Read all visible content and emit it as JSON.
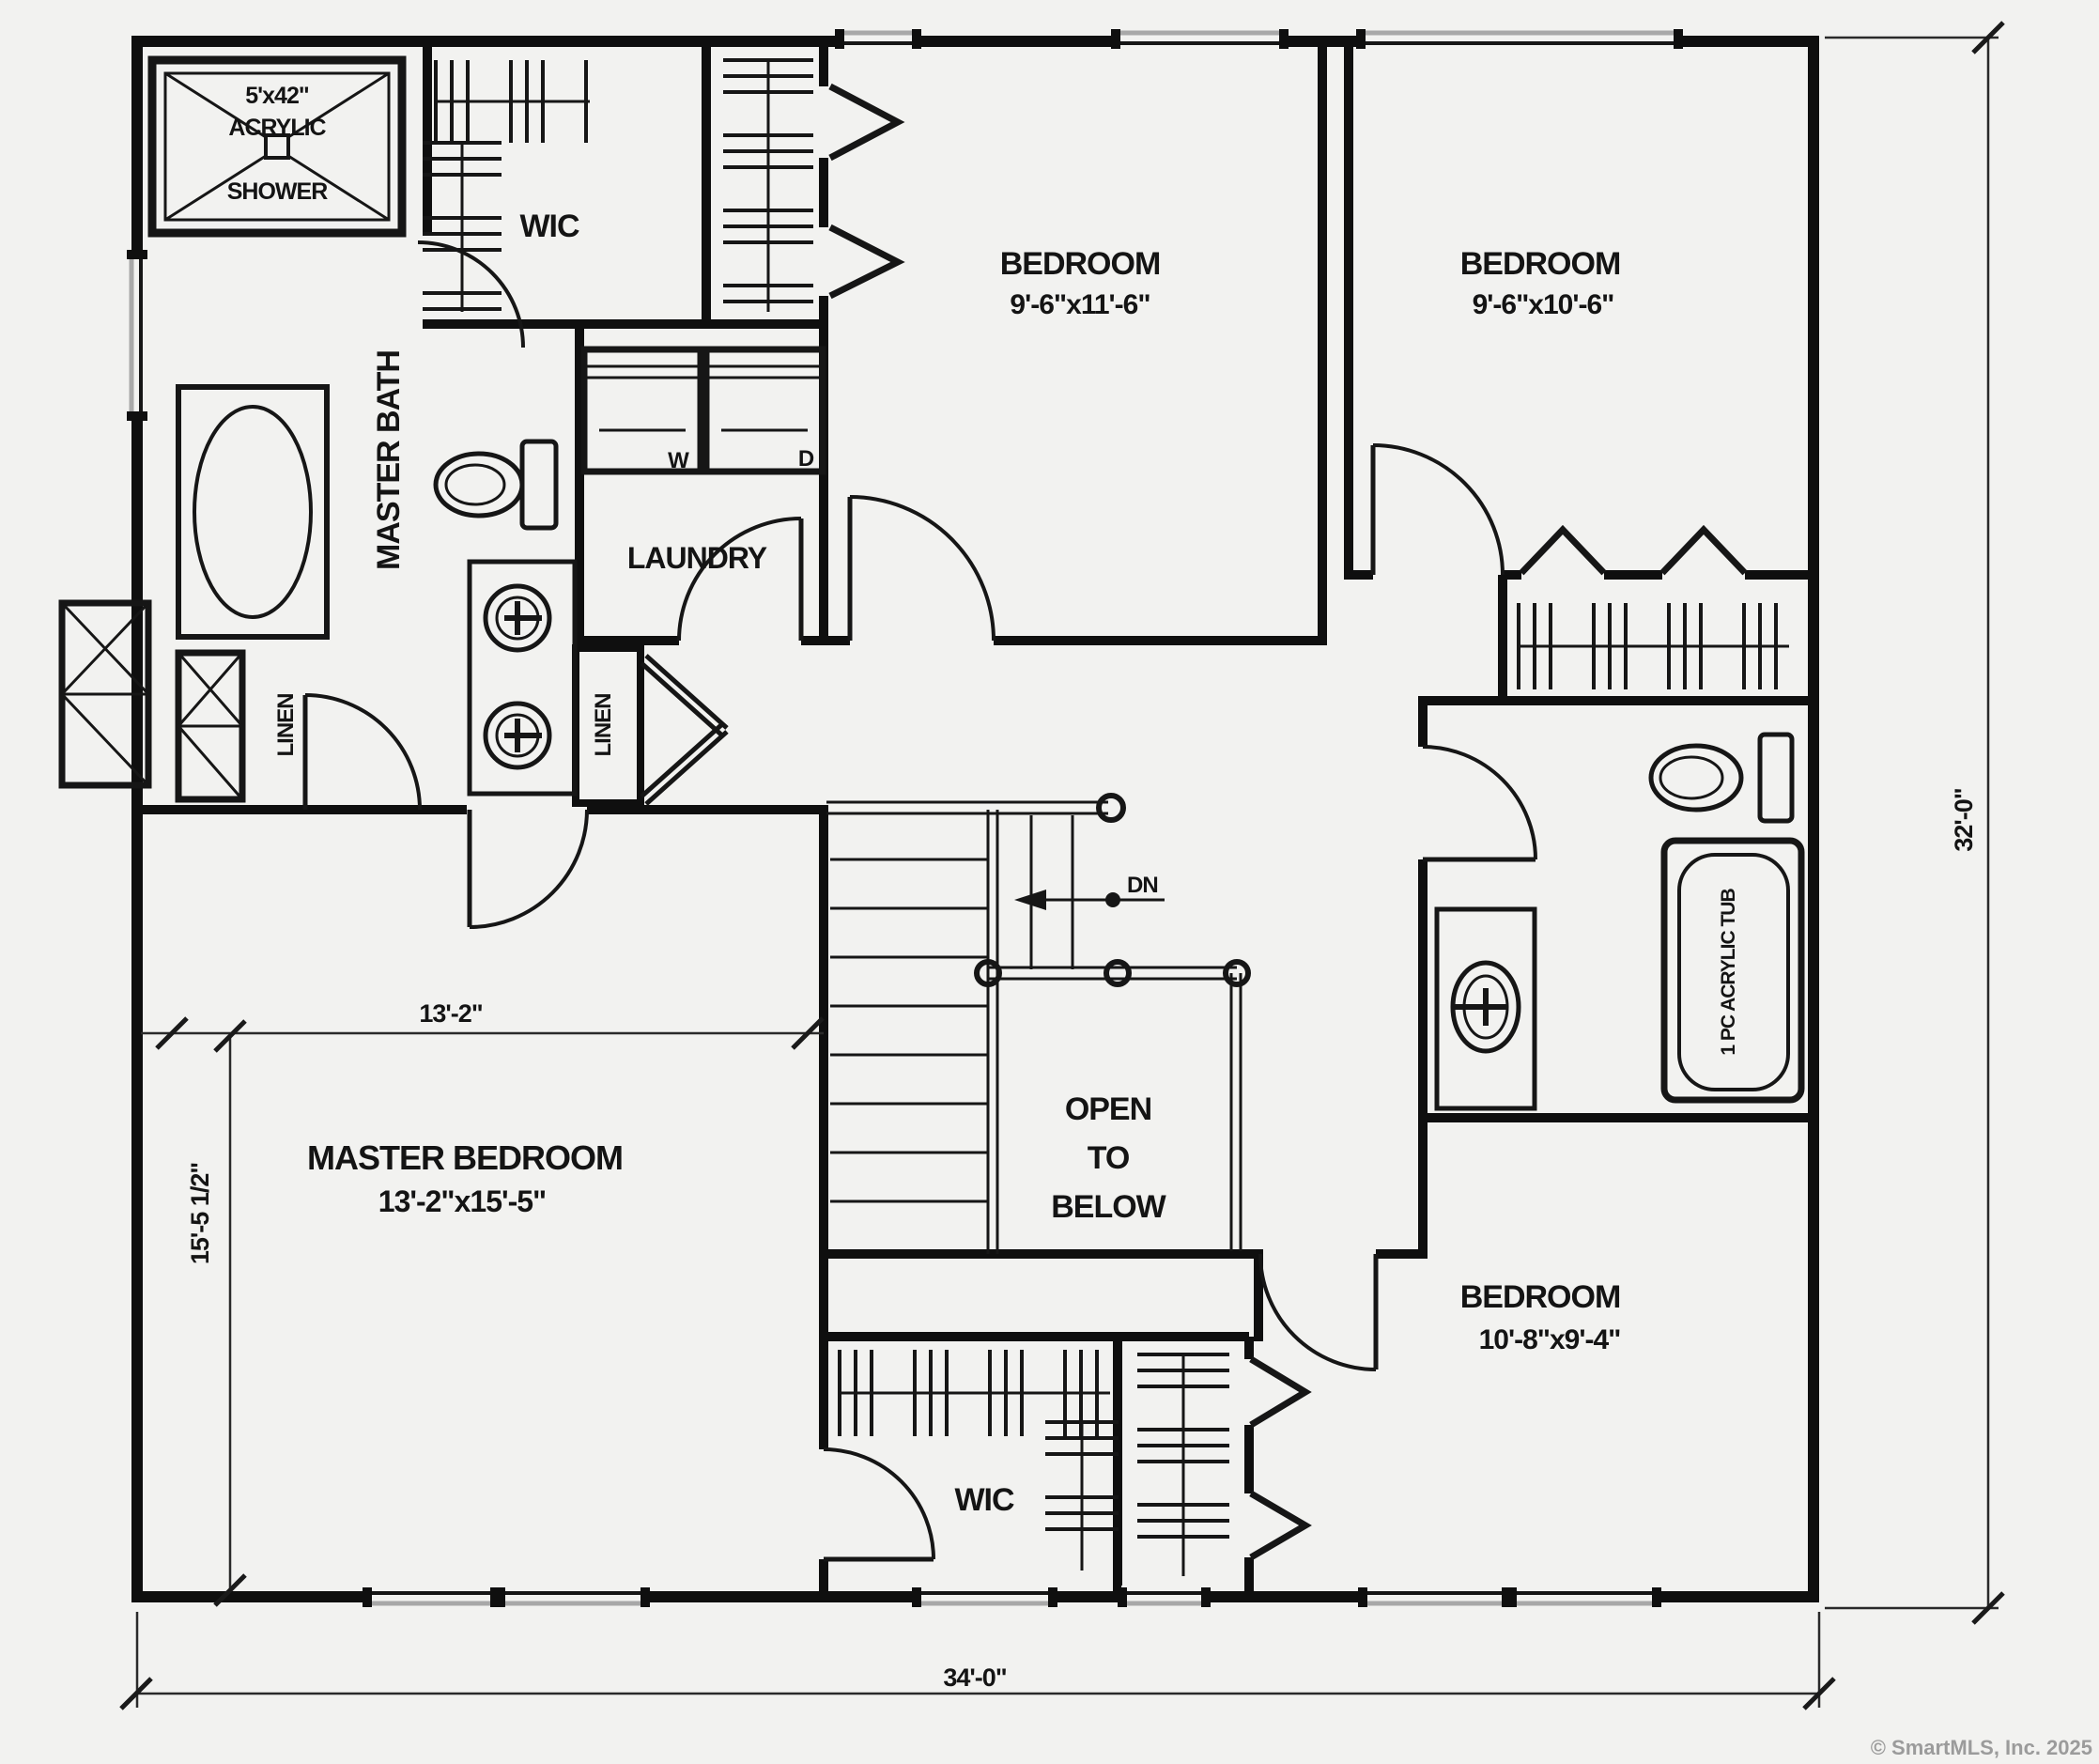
{
  "plan": {
    "rooms": {
      "master_bath": "MASTER BATH",
      "wic_top": "WIC",
      "laundry": "LAUNDRY",
      "bedroom_top_center": {
        "label": "BEDROOM",
        "dims": "9'-6\"x11'-6\""
      },
      "bedroom_top_right": {
        "label": "BEDROOM",
        "dims": "9'-6\"x10'-6\""
      },
      "master_bedroom": {
        "label": "MASTER BEDROOM",
        "dims": "13'-2\"x15'-5\""
      },
      "bedroom_bottom_right": {
        "label": "BEDROOM",
        "dims": "10'-8\"x9'-4\""
      },
      "wic_bottom": "WIC",
      "linen_left": "LINEN",
      "linen_hall": "LINEN",
      "open_to_below": {
        "line1": "OPEN",
        "line2": "TO",
        "line3": "BELOW"
      }
    },
    "fixtures": {
      "shower": {
        "line1": "5'x42\"",
        "line2": "ACRYLIC",
        "line3": "SHOWER"
      },
      "tub": "1 PC ACRYLIC TUB",
      "washer": "W",
      "dryer": "D",
      "stair_direction": "DN"
    },
    "dimensions": {
      "overall_width": "34'-0\"",
      "overall_height": "32'-0\"",
      "master_width": "13'-2\"",
      "master_height": "15'-5 1/2\""
    },
    "colors": {
      "line": "#0f0f0f",
      "paper": "#f2f2f0",
      "room_fill": "#f7f7f5",
      "copyright": "#9b9b9b"
    }
  },
  "footer": {
    "copyright": "© SmartMLS, Inc.  2025"
  }
}
